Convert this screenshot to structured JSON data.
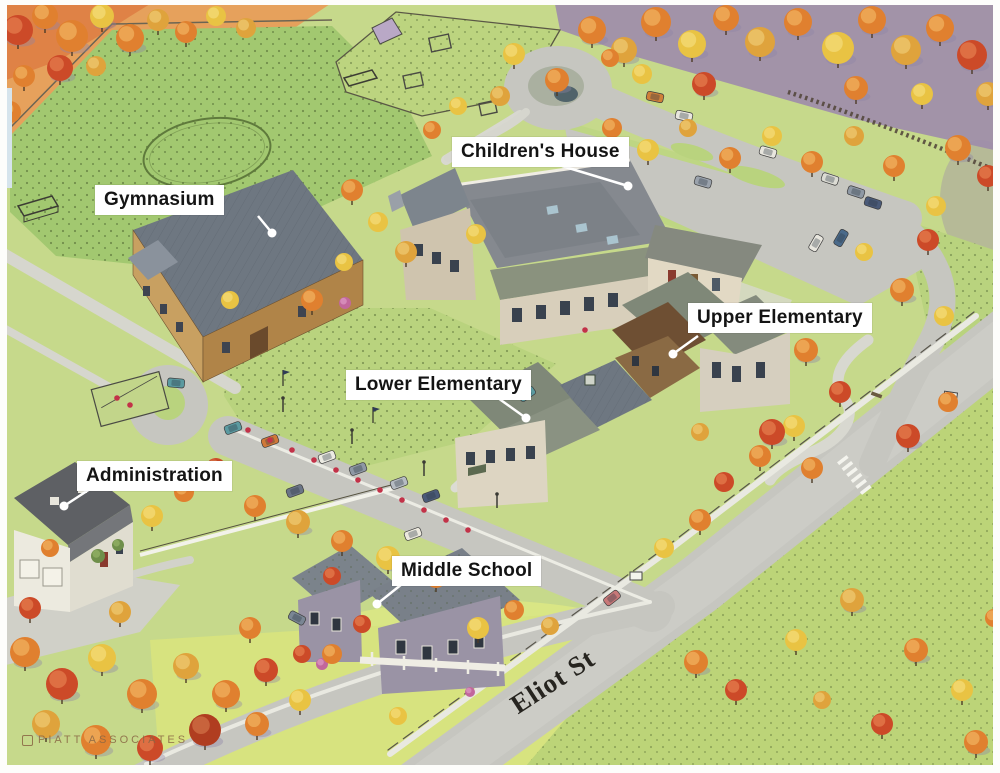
{
  "map": {
    "building_labels": [
      {
        "id": "gymnasium",
        "label": "Gymnasium"
      },
      {
        "id": "childrens-house",
        "label": "Children's House"
      },
      {
        "id": "upper-elementary",
        "label": "Upper Elementary"
      },
      {
        "id": "lower-elementary",
        "label": "Lower Elementary"
      },
      {
        "id": "administration",
        "label": "Administration"
      },
      {
        "id": "middle-school",
        "label": "Middle School"
      }
    ],
    "street_labels": [
      {
        "id": "eliot-st",
        "label": "Eliot St"
      }
    ],
    "credit": "PIATT ASSOCIATES"
  },
  "palette": {
    "label_bg": "#ffffff",
    "label_text": "#141414",
    "leader": "#ffffff",
    "grass": "#bdd47c",
    "field_green": "#a2c870",
    "road_gray": "#c6c6c0",
    "roof_gray": "#79828b",
    "tree_orange": "#e0802f",
    "tree_red": "#cc4a28",
    "tree_yellow": "#e9c343",
    "street_text": "#26241f",
    "credit_text": "#8a6744"
  }
}
